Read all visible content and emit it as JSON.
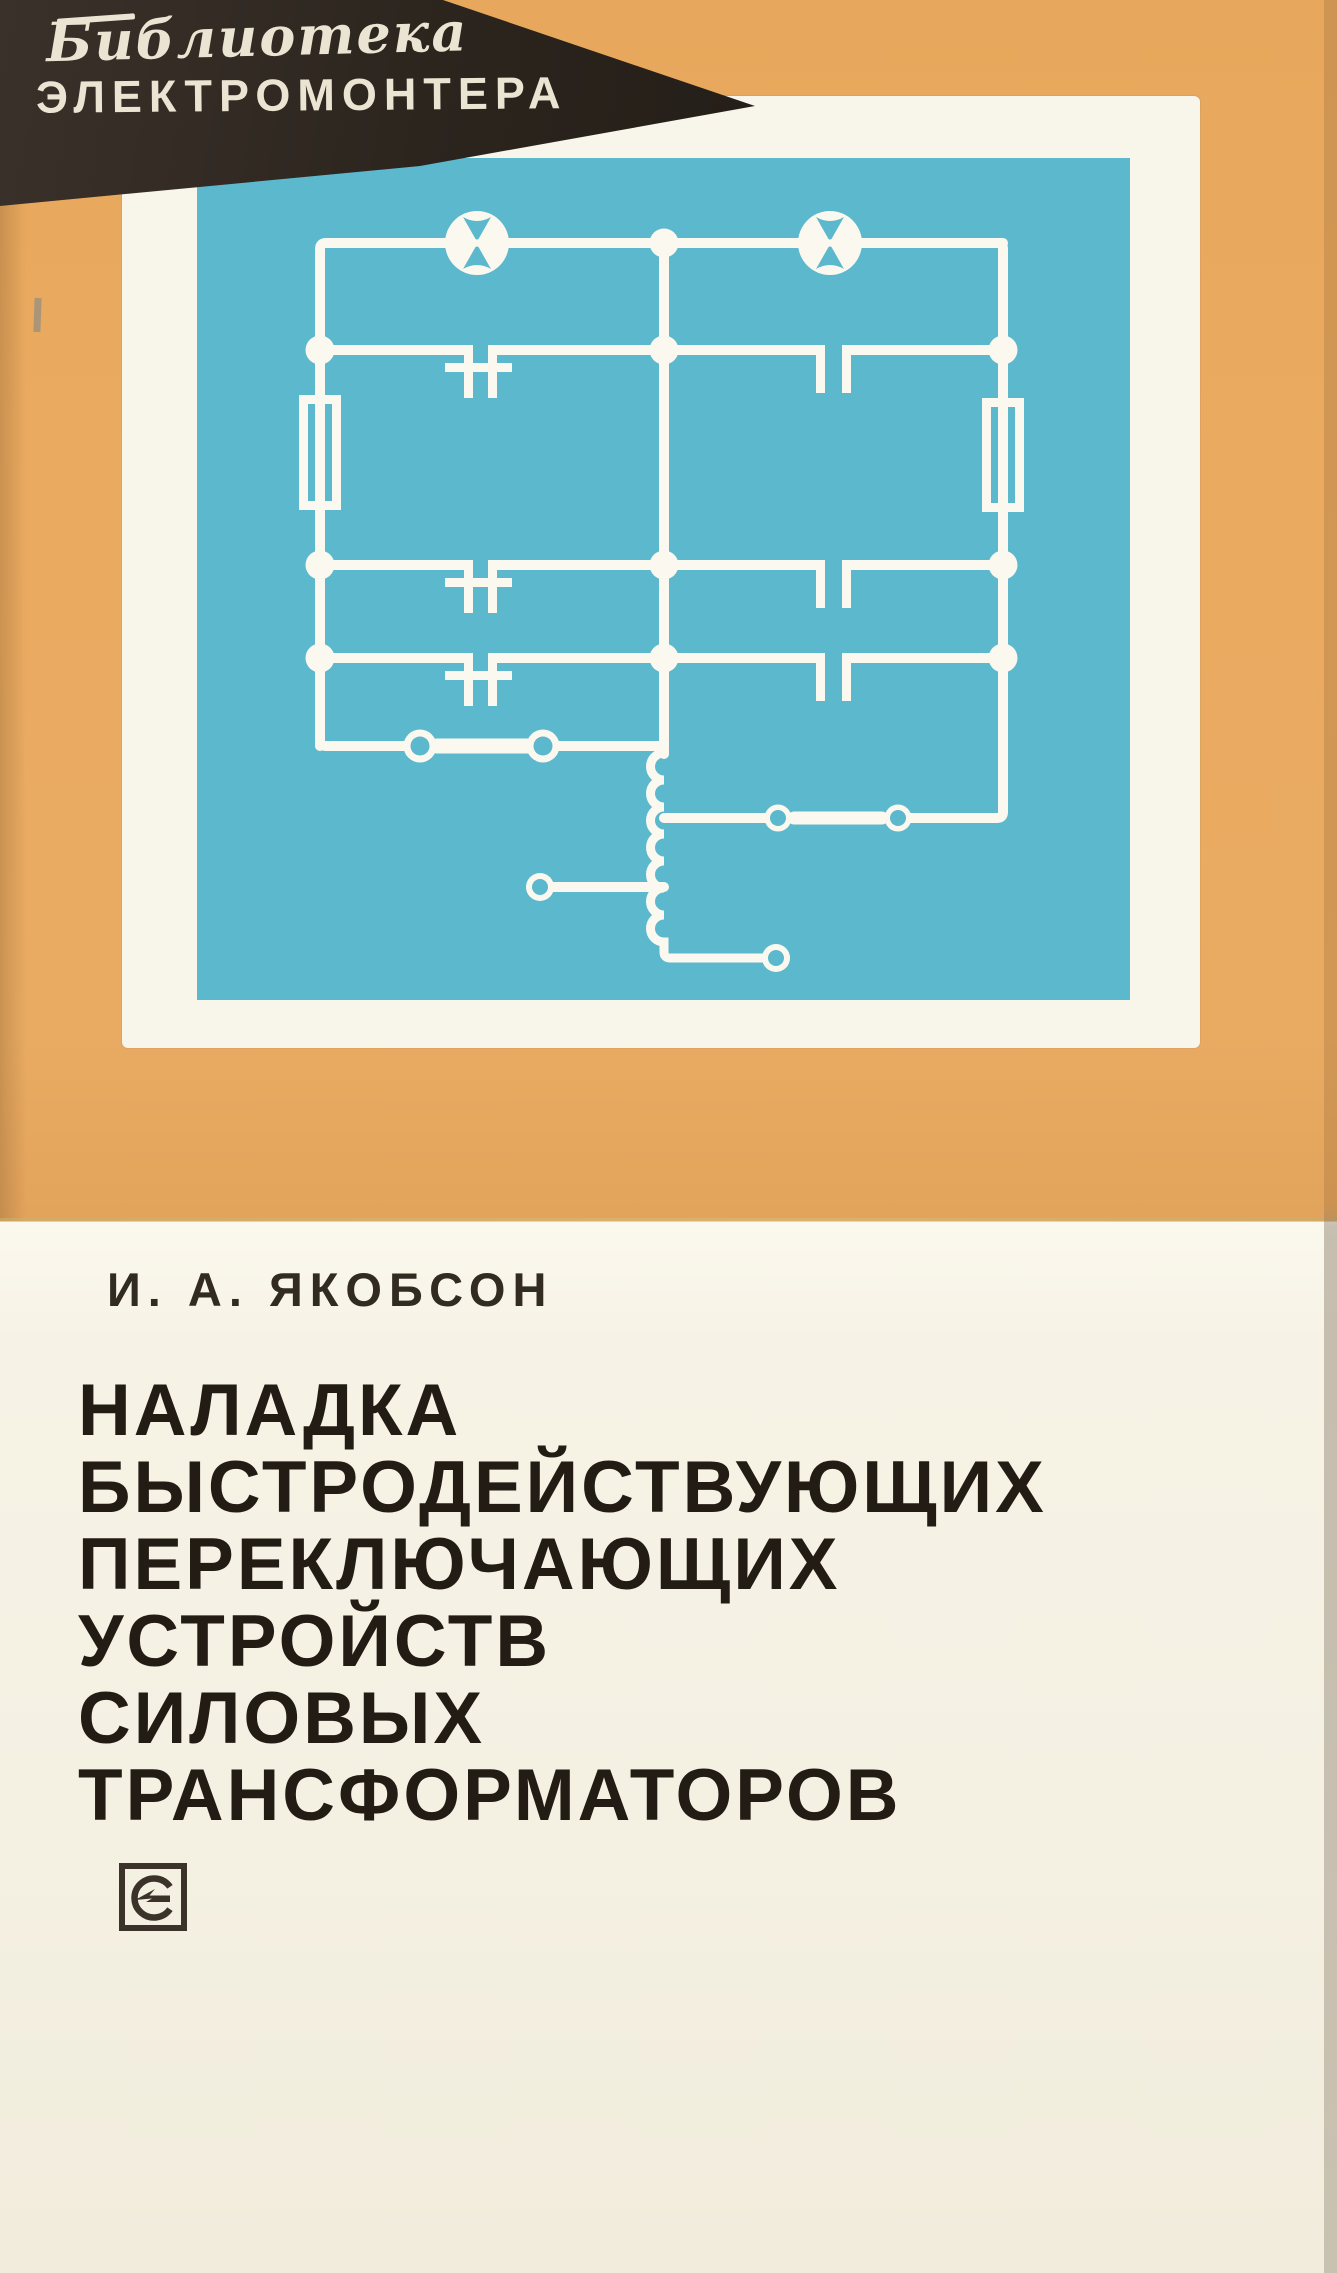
{
  "cover": {
    "series_banner": {
      "line1": "Библиотека",
      "line2": "ЭЛЕКТРОМОНТЕРА"
    },
    "author": "И. А. ЯКОБСОН",
    "title_lines": [
      "НАЛАДКА",
      "БЫСТРОДЕЙСТВУЮЩИХ",
      "ПЕРЕКЛЮЧАЮЩИХ",
      "УСТРОЙСТВ",
      "СИЛОВЫХ",
      "ТРАНСФОРМАТОРОВ"
    ],
    "publisher_logo": "energiya-publisher-logo",
    "schematic_symbols": [
      "lamp-icon",
      "capacitor-contact-icon",
      "resistor-icon",
      "inductor-coil-icon",
      "fuse-contact-icon",
      "terminal-icon"
    ],
    "colors": {
      "tan_background": "#e9a95e",
      "cyan_plate": "#5cb8cd",
      "panel_white": "#f8f5ea",
      "cream_background": "#f4f0e2",
      "banner_black": "#2c251e",
      "banner_text": "#ece4d2",
      "title_text": "#221c15",
      "schematic_white": "#fbf9ef",
      "logo_ink": "#3b332a"
    }
  }
}
